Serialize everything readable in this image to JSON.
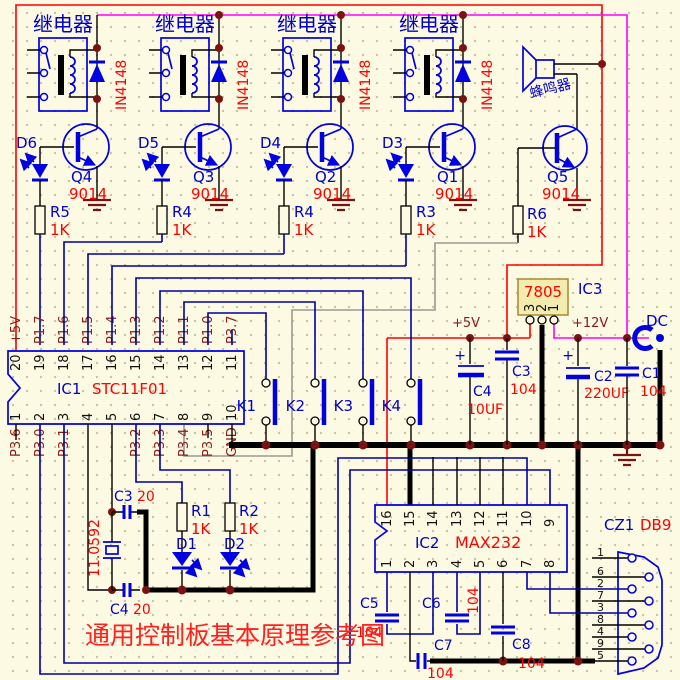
{
  "title": "通用控制板基本原理参考图",
  "relay": {
    "label": "继电器",
    "diode": "IN4148"
  },
  "channels": [
    {
      "led": "D6",
      "q": "Q4",
      "qp": "9014",
      "r": "R5",
      "rv": "1K"
    },
    {
      "led": "D5",
      "q": "Q3",
      "qp": "9014",
      "r": "R4",
      "rv": "1K"
    },
    {
      "led": "D4",
      "q": "Q2",
      "qp": "9014",
      "r": "R4",
      "rv": "1K"
    },
    {
      "led": "D3",
      "q": "Q1",
      "qp": "9014",
      "r": "R3",
      "rv": "1K"
    }
  ],
  "buzzer": {
    "label": "蜂鸣器",
    "q": "Q5",
    "qp": "9014",
    "r": "R6",
    "rv": "1K"
  },
  "ic1": {
    "ref": "IC1",
    "part": "STC11F01",
    "top": [
      {
        "n": "20",
        "l": "+5V"
      },
      {
        "n": "19",
        "l": "P1.7"
      },
      {
        "n": "18",
        "l": "P1.6"
      },
      {
        "n": "17",
        "l": "P1.5"
      },
      {
        "n": "16",
        "l": "P1.4"
      },
      {
        "n": "15",
        "l": "P1.3"
      },
      {
        "n": "14",
        "l": "P1.2"
      },
      {
        "n": "13",
        "l": "P1.1"
      },
      {
        "n": "12",
        "l": "P1.0"
      },
      {
        "n": "11",
        "l": "P3.7"
      }
    ],
    "bottom": [
      {
        "n": "1",
        "l": "P3.6"
      },
      {
        "n": "2",
        "l": "P3.0"
      },
      {
        "n": "3",
        "l": "P3.1"
      },
      {
        "n": "4",
        "l": ""
      },
      {
        "n": "5",
        "l": ""
      },
      {
        "n": "6",
        "l": "P3.2"
      },
      {
        "n": "7",
        "l": "P3.3"
      },
      {
        "n": "8",
        "l": "P3.4"
      },
      {
        "n": "9",
        "l": "P3.5"
      },
      {
        "n": "10",
        "l": "GND"
      }
    ]
  },
  "keys": [
    "K1",
    "K2",
    "K3",
    "K4"
  ],
  "reg": {
    "ref": "IC3",
    "part": "7805",
    "pins": [
      "3",
      "2",
      "1"
    ]
  },
  "power": {
    "p5": "+5V",
    "p12": "+12V",
    "dc": "DC"
  },
  "caps": {
    "c1": "C1",
    "c1v": "104",
    "c2": "C2",
    "c2v": "220UF",
    "c3": "C3",
    "c3v": "104",
    "c4": "C4",
    "c4v": "10UF",
    "xc3": "C3",
    "xc3v": "20",
    "xc4": "C4",
    "xc4v": "20",
    "c5": "C5",
    "c5v": "104",
    "c6": "C6",
    "c6v": "104",
    "c7": "C7",
    "c7v": "104",
    "c8": "C8",
    "c8v": "104"
  },
  "xtal": "11.0592",
  "leds": {
    "d1": "D1",
    "d2": "D2",
    "r1": "R1",
    "r1v": "1K",
    "r2": "R2",
    "r2v": "1K"
  },
  "ic2": {
    "ref": "IC2",
    "part": "MAX232",
    "top": [
      "16",
      "15",
      "14",
      "13",
      "12",
      "11",
      "10",
      "9"
    ],
    "bottom": [
      "1",
      "2",
      "3",
      "4",
      "5",
      "6",
      "7",
      "8"
    ]
  },
  "db9": {
    "ref": "CZ1",
    "part": "DB9",
    "pins": [
      "1",
      "6",
      "2",
      "7",
      "3",
      "8",
      "4",
      "9",
      "5"
    ]
  },
  "colors": {
    "wire_red": "#ff0000",
    "wire_magenta": "#ff00ff",
    "wire_blue": "#0000a0",
    "component_blue": "#0000e0",
    "junction": "#7a1212",
    "label_dark_red": "#8b1a1a",
    "value_red": "#ff0000",
    "bg": "#fcfae3",
    "reg_fill": "#f2ecae"
  }
}
